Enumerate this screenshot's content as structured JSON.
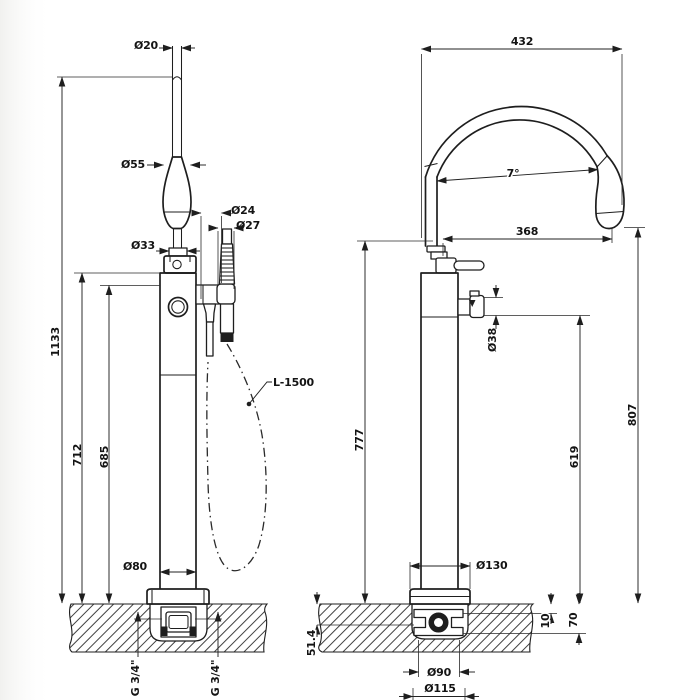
{
  "drawing": {
    "background": "#ffffff",
    "line_color": "#1e1e1e",
    "front_view": {
      "dia_spout_top": "Ø20",
      "dia_spout_widest": "Ø55",
      "dia_spout_neck": "Ø33",
      "dia_holder": "Ø24",
      "dia_handshower": "Ø27",
      "height_total": "1133",
      "height_spout_outlet": "712",
      "height_handshower": "685",
      "dia_column": "Ø80",
      "hose_length": "L-1500",
      "inlet_left_thread": "G 3/4\"",
      "inlet_right_thread": "G 3/4\""
    },
    "side_view": {
      "spout_width": "432",
      "spout_angle": "7°",
      "spout_reach": "368",
      "dia_side_port": "Ø38",
      "height_spout_tip": "807",
      "height_body": "777",
      "height_side_port": "619",
      "dia_base_plate": "Ø130",
      "depth_box_top": "10",
      "depth_box_bottom": "70",
      "depth_inlet_axis": "51.4",
      "dia_rough_body": "Ø90",
      "dia_floor_hole": "Ø115"
    }
  }
}
